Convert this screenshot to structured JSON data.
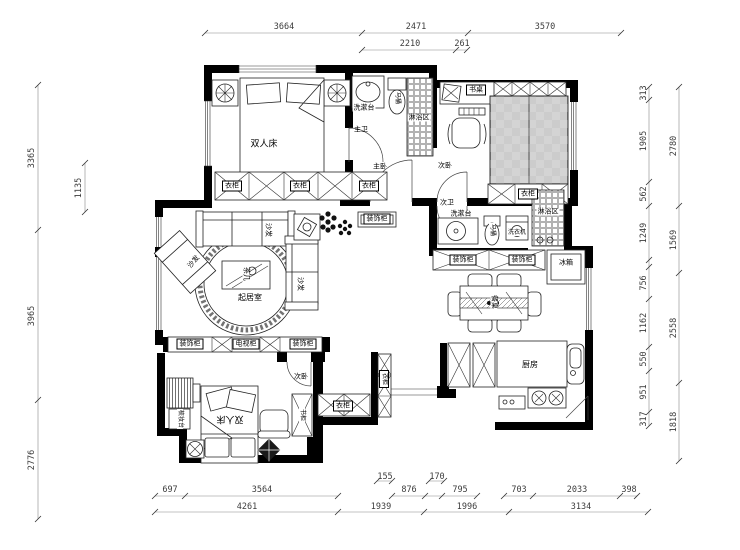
{
  "drawing": {
    "type": "residential floor plan",
    "units": "mm",
    "wall_color": "#000000",
    "line_color": "#444444",
    "background": "#ffffff"
  },
  "rooms": {
    "living": "起居室",
    "kitchen": "厨房",
    "master_bedroom": "主卧",
    "master_bath": "主卫",
    "second_bedroom": "次卧",
    "second_bath": "次卫"
  },
  "furniture": {
    "double_bed": "双人床",
    "wardrobe": "衣柜",
    "desk": "书桌",
    "washbasin": "洗漱台",
    "shower_area": "淋浴区",
    "toilet": "马桶",
    "washing_machine": "洗衣机",
    "fridge": "冰箱",
    "decorative_cabinet": "装饰柜",
    "tv_cabinet": "电视柜",
    "tea_table": "茶几",
    "dining_table": "餐桌",
    "sofa": "沙发",
    "bookcase": "书柜",
    "dressing_table": "梳妆台"
  },
  "dimensions": {
    "top_row1": [
      "3664",
      "2471",
      "3570"
    ],
    "top_row2": [
      "2210",
      "261"
    ],
    "left_outer": [
      "3365",
      "3965",
      "2776"
    ],
    "left_inner": [
      "1135"
    ],
    "right_inner": [
      "313",
      "1905",
      "562",
      "1249",
      "756",
      "1162",
      "550",
      "951",
      "317"
    ],
    "right_outer": [
      "2780",
      "1569",
      "2558",
      "1818"
    ],
    "bottom_row0": [
      "155",
      "170"
    ],
    "bottom_row1": [
      "697",
      "3564",
      "876",
      "795",
      "703",
      "2033",
      "398"
    ],
    "bottom_row2": [
      "4261",
      "1939",
      "1996",
      "3134"
    ]
  }
}
